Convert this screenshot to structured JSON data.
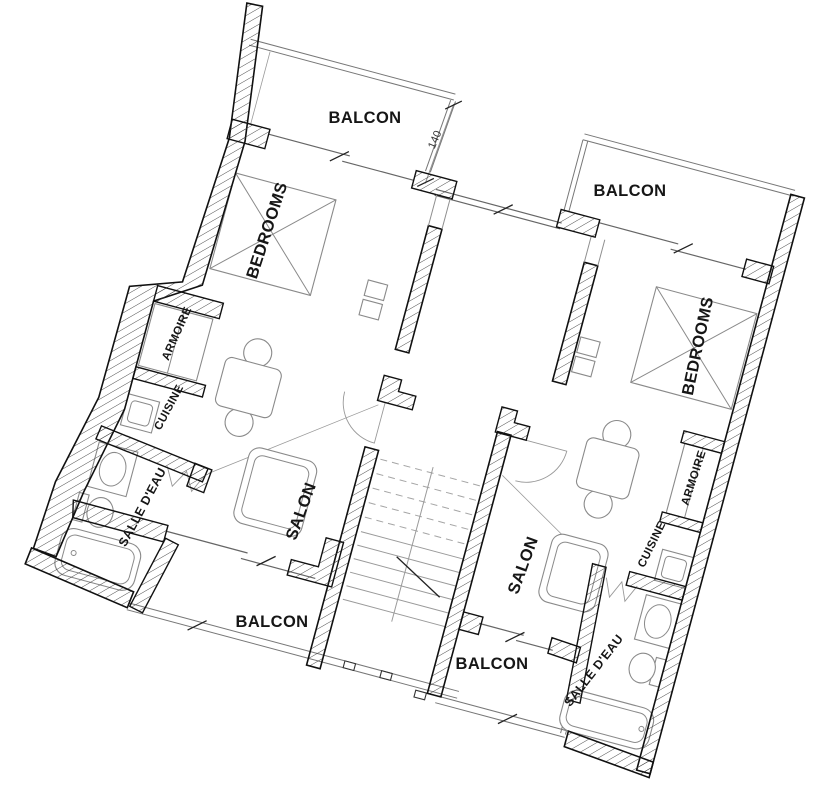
{
  "drawing": {
    "type": "architectural-floor-plan",
    "background_color": "#ffffff",
    "wall_color": "#111111",
    "thin_line_color": "#8f8f8f",
    "description": "Two mirrored apartment units with central staircase"
  },
  "labels": [
    {
      "id": "balcon-top-left",
      "text": "BALCON"
    },
    {
      "id": "balcon-top-right",
      "text": "BALCON"
    },
    {
      "id": "bedrooms-left",
      "text": "BEDROOMS"
    },
    {
      "id": "bedrooms-right",
      "text": "BEDROOMS"
    },
    {
      "id": "armoire-left",
      "text": "ARMOIRE"
    },
    {
      "id": "cuisine-left",
      "text": "CUISINE"
    },
    {
      "id": "salle-deau-left",
      "text": "SALLE D'EAU"
    },
    {
      "id": "salon-left",
      "text": "SALON"
    },
    {
      "id": "salon-right",
      "text": "SALON"
    },
    {
      "id": "balcon-bottom-left",
      "text": "BALCON"
    },
    {
      "id": "balcon-bottom-right",
      "text": "BALCON"
    },
    {
      "id": "cuisine-right",
      "text": "CUISINE"
    },
    {
      "id": "armoire-right",
      "text": "ARMOIRE"
    },
    {
      "id": "salle-deau-right",
      "text": "SALLE D'EAU"
    },
    {
      "id": "dim-140",
      "text": "140"
    }
  ]
}
